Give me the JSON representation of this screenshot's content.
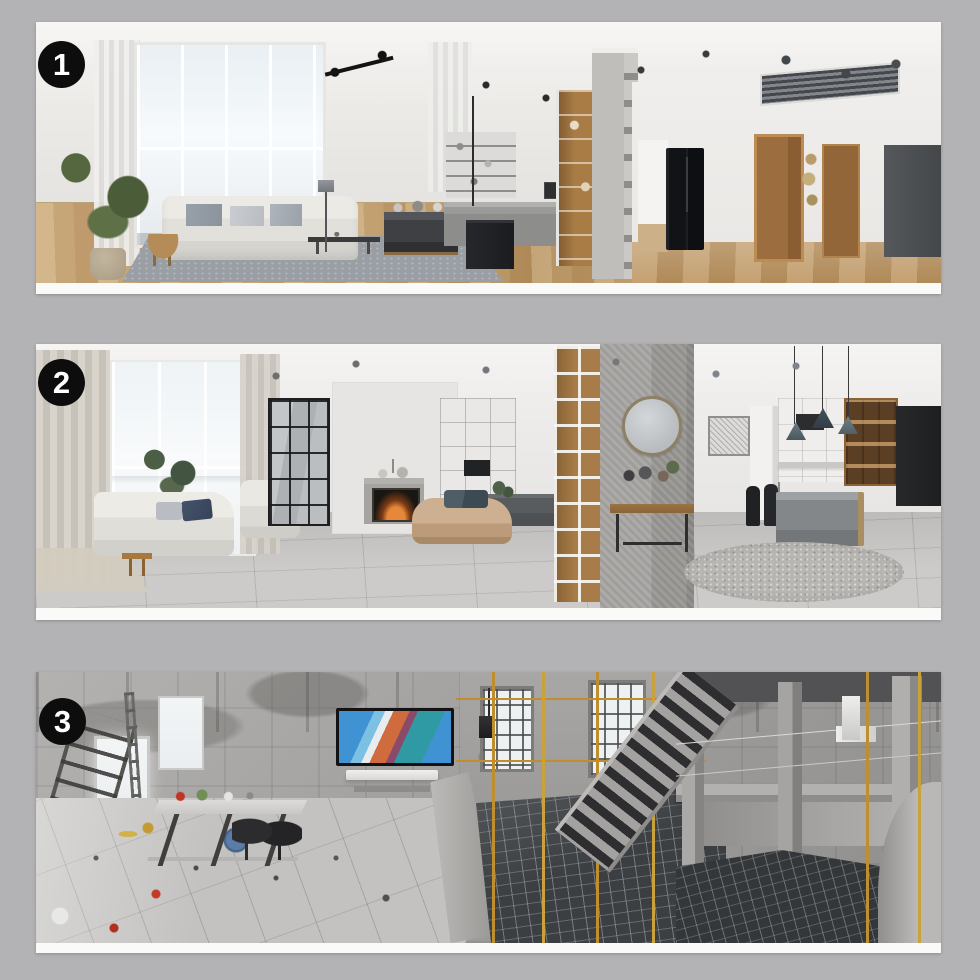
{
  "page": {
    "background_color": "#b3b2b4",
    "photo_strip_white": "#fafaf8"
  },
  "badge_style": {
    "background": "#0d0d0d",
    "text_color": "#ffffff"
  },
  "panels": [
    {
      "badge": "1"
    },
    {
      "badge": "2"
    },
    {
      "badge": "3"
    }
  ],
  "palette": {
    "wood_floor": "#c2996a",
    "tile_floor": "#c6c5c3",
    "concrete_gray": "#a3a2a0",
    "rebar_pit_dark": "#3c3f42",
    "scaffold_yellow": "#bf8e2f",
    "sofa_white": "#e8e6e1",
    "daybed_tan": "#c4a382",
    "navy_pillow": "#3e4c60",
    "tv_screen_blue": "#3f93d2",
    "tv_screen_orange": "#cf6b3c",
    "plant_green": "#50614a"
  }
}
